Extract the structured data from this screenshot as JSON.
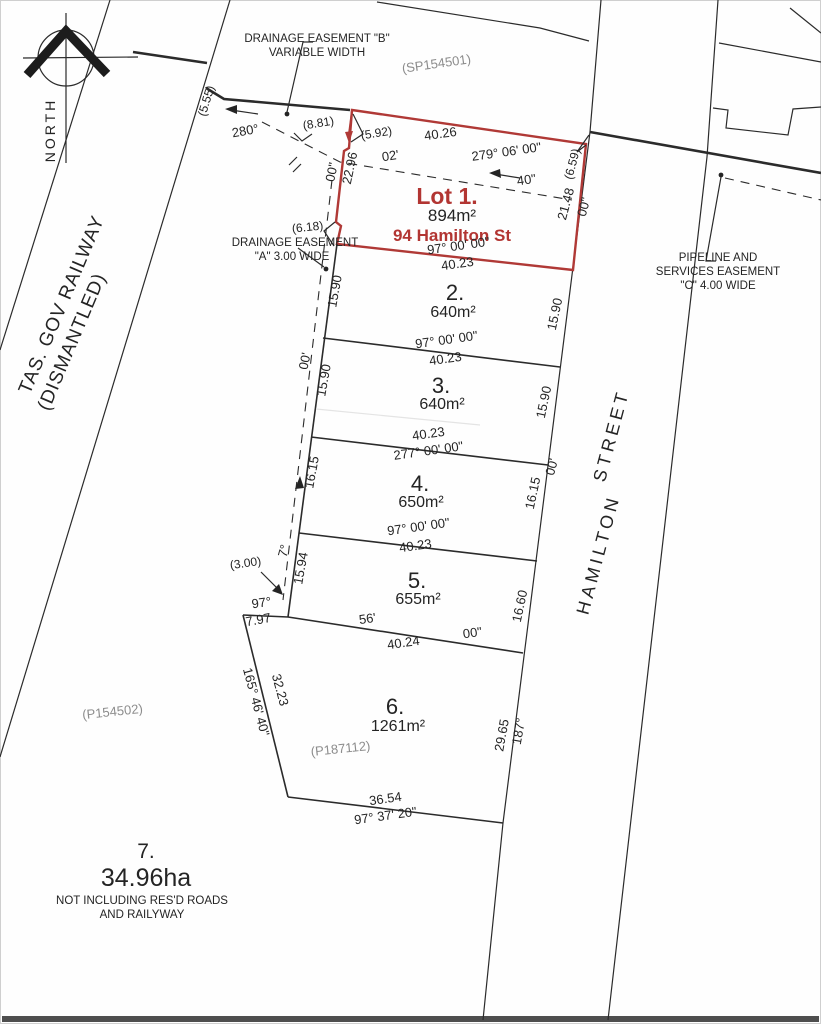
{
  "document": {
    "type": "cadastral survey plan",
    "highlight_color": "#b03936",
    "line_color": "#2b2b2b",
    "plan_reference_color": "#8c8c8c"
  },
  "lots_summary": [
    {
      "id": "1",
      "area": "894m²",
      "address": "94 Hamilton St",
      "highlighted": true
    },
    {
      "id": "2",
      "area": "640m²"
    },
    {
      "id": "3",
      "area": "640m²"
    },
    {
      "id": "4",
      "area": "650m²"
    },
    {
      "id": "5",
      "area": "655m²"
    },
    {
      "id": "6",
      "area": "1261m²"
    },
    {
      "id": "7",
      "area": "34.96ha",
      "note": "NOT INCLUDING RES'D ROADS AND RAILYWAY"
    }
  ],
  "labels": [
    {
      "name": "north-label",
      "text": "NORTH",
      "x": 55,
      "y": 130,
      "rot": -90,
      "cls": "north"
    },
    {
      "name": "railway-label-1",
      "text": "TAS. GOV RAILWAY",
      "x": 67,
      "y": 307,
      "rot": -67,
      "cls": "rail"
    },
    {
      "name": "railway-label-2",
      "text": "(DISMANTLED)",
      "x": 67,
      "y": 307,
      "rot": -67,
      "dx": -30,
      "dy": 24,
      "cls": "rail"
    },
    {
      "name": "street-label-1",
      "text": "HAMILTON",
      "x": 604,
      "y": 556,
      "rot": -75,
      "cls": "street"
    },
    {
      "name": "street-label-2",
      "text": "STREET",
      "x": 617,
      "y": 437,
      "rot": -75,
      "cls": "street"
    },
    {
      "name": "plan-ref-sp154501",
      "text": "(SP154501)",
      "x": 437,
      "y": 68,
      "rot": -8,
      "cls": "plan"
    },
    {
      "name": "easement-b-line1",
      "text": "DRAINAGE EASEMENT \"B\"",
      "x": 317,
      "y": 42,
      "rot": 0,
      "cls": "ease",
      "anchor": "start"
    },
    {
      "name": "easement-b-line2",
      "text": "VARIABLE WIDTH",
      "x": 317,
      "y": 56,
      "rot": 0,
      "cls": "ease",
      "anchor": "start"
    },
    {
      "name": "dim-5-55",
      "text": "(5.55)",
      "x": 210,
      "y": 102,
      "rot": -73,
      "cls": "small"
    },
    {
      "name": "bearing-280",
      "text": "280°",
      "x": 246,
      "y": 135,
      "rot": -10,
      "cls": "dim"
    },
    {
      "name": "dim-8-81",
      "text": "(8.81)",
      "x": 319,
      "y": 127,
      "rot": -9,
      "cls": "small"
    },
    {
      "name": "dim-5-92",
      "text": "(5.92)",
      "x": 377,
      "y": 137,
      "rot": -9,
      "cls": "small"
    },
    {
      "name": "lot1-west-length",
      "text": "22.96",
      "x": 354,
      "y": 169,
      "rot": -78,
      "cls": "dim"
    },
    {
      "name": "bearing-frag-00s-a",
      "text": "00\"",
      "x": 336,
      "y": 173,
      "rot": -78,
      "cls": "dim"
    },
    {
      "name": "bearing-frag-02m",
      "text": "02'",
      "x": 391,
      "y": 160,
      "rot": -9,
      "cls": "dim"
    },
    {
      "name": "lot1-top-length",
      "text": "40.26",
      "x": 441,
      "y": 138,
      "rot": -8,
      "cls": "dim"
    },
    {
      "name": "lot1-top-bearing",
      "text": "279° 06' 00\"",
      "x": 507,
      "y": 156,
      "rot": -8,
      "cls": "dim"
    },
    {
      "name": "bearing-frag-40s",
      "text": "40\"",
      "x": 527,
      "y": 184,
      "rot": -8,
      "cls": "dim"
    },
    {
      "name": "dim-6-59",
      "text": "(6.59)",
      "x": 576,
      "y": 165,
      "rot": -75,
      "cls": "small"
    },
    {
      "name": "lot1-east-length",
      "text": "21.48",
      "x": 570,
      "y": 205,
      "rot": -75,
      "cls": "dim"
    },
    {
      "name": "bearing-frag-00s-b",
      "text": "00\"",
      "x": 588,
      "y": 208,
      "rot": -75,
      "cls": "dim"
    },
    {
      "name": "lot1-name",
      "text": "Lot 1.",
      "x": 447,
      "y": 204,
      "rot": 0,
      "cls": "lot1name"
    },
    {
      "name": "lot1-area",
      "text": "894m²",
      "x": 452,
      "y": 221,
      "rot": 0,
      "cls": "lot1area"
    },
    {
      "name": "lot1-address",
      "text": "94 Hamilton St",
      "x": 452,
      "y": 241,
      "rot": 0,
      "cls": "lot1addr"
    },
    {
      "name": "lot1-bottom-bearing",
      "text": "97° 00' 00\"",
      "x": 459,
      "y": 250,
      "rot": -8,
      "cls": "dim"
    },
    {
      "name": "lot1-bottom-length",
      "text": "40.23",
      "x": 458,
      "y": 268,
      "rot": -8,
      "cls": "dim"
    },
    {
      "name": "easement-a-line1",
      "text": "DRAINAGE EASEMENT",
      "x": 295,
      "y": 246,
      "rot": 0,
      "cls": "ease",
      "anchor": "end"
    },
    {
      "name": "easement-a-line2",
      "text": "\"A\" 3.00 WIDE",
      "x": 292,
      "y": 260,
      "rot": 0,
      "cls": "ease",
      "anchor": "end"
    },
    {
      "name": "dim-6-18",
      "text": "(6.18)",
      "x": 308,
      "y": 231,
      "rot": -6,
      "cls": "small"
    },
    {
      "name": "lot2-west-length",
      "text": "15.90",
      "x": 339,
      "y": 292,
      "rot": -80,
      "cls": "dim"
    },
    {
      "name": "lot2-number",
      "text": "2.",
      "x": 455,
      "y": 300,
      "rot": 0,
      "cls": "lotnum"
    },
    {
      "name": "lot2-area",
      "text": "640m²",
      "x": 453,
      "y": 317,
      "rot": 0,
      "cls": "area"
    },
    {
      "name": "lot2-east-length",
      "text": "15.90",
      "x": 559,
      "y": 315,
      "rot": -78,
      "cls": "dim"
    },
    {
      "name": "lot2-3-bearing",
      "text": "97° 00' 00\"",
      "x": 447,
      "y": 344,
      "rot": -8,
      "cls": "dim"
    },
    {
      "name": "lot2-3-length",
      "text": "40.23",
      "x": 446,
      "y": 363,
      "rot": -8,
      "cls": "dim"
    },
    {
      "name": "bearing-frag-00m-e",
      "text": "00'",
      "x": 309,
      "y": 362,
      "rot": -78,
      "cls": "dim"
    },
    {
      "name": "lot3-west-length",
      "text": "15.90",
      "x": 328,
      "y": 381,
      "rot": -80,
      "cls": "dim"
    },
    {
      "name": "lot3-number",
      "text": "3.",
      "x": 441,
      "y": 393,
      "rot": 0,
      "cls": "lotnum"
    },
    {
      "name": "lot3-area",
      "text": "640m²",
      "x": 442,
      "y": 409,
      "rot": 0,
      "cls": "area"
    },
    {
      "name": "lot3-east-length",
      "text": "15.90",
      "x": 548,
      "y": 403,
      "rot": -78,
      "cls": "dim"
    },
    {
      "name": "lot3-4-length",
      "text": "40.23",
      "x": 429,
      "y": 438,
      "rot": -8,
      "cls": "dim"
    },
    {
      "name": "lot3-4-bearing",
      "text": "277° 00' 00\"",
      "x": 429,
      "y": 455,
      "rot": -8,
      "cls": "dim"
    },
    {
      "name": "lot4-west-length",
      "text": "16.15",
      "x": 316,
      "y": 473,
      "rot": -80,
      "cls": "dim"
    },
    {
      "name": "bearing-frag-00m-c",
      "text": "00'",
      "x": 556,
      "y": 468,
      "rot": -75,
      "cls": "dim"
    },
    {
      "name": "lot4-number",
      "text": "4.",
      "x": 420,
      "y": 491,
      "rot": 0,
      "cls": "lotnum"
    },
    {
      "name": "lot4-area",
      "text": "650m²",
      "x": 421,
      "y": 507,
      "rot": 0,
      "cls": "area"
    },
    {
      "name": "lot4-east-length",
      "text": "16.15",
      "x": 537,
      "y": 494,
      "rot": -78,
      "cls": "dim"
    },
    {
      "name": "lot4-5-bearing",
      "text": "97° 00' 00\"",
      "x": 419,
      "y": 531,
      "rot": -8,
      "cls": "dim"
    },
    {
      "name": "lot4-5-length",
      "text": "40.23",
      "x": 416,
      "y": 550,
      "rot": -8,
      "cls": "dim"
    },
    {
      "name": "bearing-frag-7d",
      "text": "7°",
      "x": 288,
      "y": 552,
      "rot": -75,
      "cls": "dim"
    },
    {
      "name": "lot5-west-length",
      "text": "15.94",
      "x": 305,
      "y": 569,
      "rot": -80,
      "cls": "dim"
    },
    {
      "name": "dim-3-00",
      "text": "(3.00)",
      "x": 246,
      "y": 567,
      "rot": -8,
      "cls": "small"
    },
    {
      "name": "lot5-number",
      "text": "5.",
      "x": 417,
      "y": 588,
      "rot": 0,
      "cls": "lotnum"
    },
    {
      "name": "lot5-area",
      "text": "655m²",
      "x": 418,
      "y": 604,
      "rot": 0,
      "cls": "area"
    },
    {
      "name": "lot5-east-length",
      "text": "16.60",
      "x": 524,
      "y": 607,
      "rot": -78,
      "cls": "dim"
    },
    {
      "name": "bearing-frag-97d",
      "text": "97°",
      "x": 262,
      "y": 607,
      "rot": -8,
      "cls": "dim"
    },
    {
      "name": "dim-7-97",
      "text": "7.97",
      "x": 259,
      "y": 624,
      "rot": -10,
      "cls": "dim"
    },
    {
      "name": "bearing-frag-56m",
      "text": "56'",
      "x": 368,
      "y": 623,
      "rot": -8,
      "cls": "dim"
    },
    {
      "name": "bearing-frag-00s-d",
      "text": "00\"",
      "x": 473,
      "y": 637,
      "rot": -8,
      "cls": "dim"
    },
    {
      "name": "lot5-6-length",
      "text": "40.24",
      "x": 404,
      "y": 647,
      "rot": -8,
      "cls": "dim"
    },
    {
      "name": "lot6-number",
      "text": "6.",
      "x": 395,
      "y": 714,
      "rot": 0,
      "cls": "lotnum"
    },
    {
      "name": "lot6-area",
      "text": "1261m²",
      "x": 398,
      "y": 731,
      "rot": 0,
      "cls": "area"
    },
    {
      "name": "plan-ref-p187112",
      "text": "(P187112)",
      "x": 341,
      "y": 753,
      "rot": -6,
      "cls": "plan"
    },
    {
      "name": "lot6-west-bearing",
      "text": "165° 46' 40\"",
      "x": 252,
      "y": 703,
      "rot": 75,
      "cls": "dim"
    },
    {
      "name": "lot6-west-length",
      "text": "32.23",
      "x": 276,
      "y": 691,
      "rot": 75,
      "cls": "dim"
    },
    {
      "name": "lot6-east-length",
      "text": "29.65",
      "x": 506,
      "y": 736,
      "rot": -80,
      "cls": "dim"
    },
    {
      "name": "bearing-frag-187d",
      "text": "187°",
      "x": 523,
      "y": 732,
      "rot": -80,
      "cls": "dim"
    },
    {
      "name": "lot6-bottom-length",
      "text": "36.54",
      "x": 386,
      "y": 803,
      "rot": -8,
      "cls": "dim"
    },
    {
      "name": "lot6-bottom-bearing",
      "text": "97° 37' 20\"",
      "x": 386,
      "y": 820,
      "rot": -8,
      "cls": "dim"
    },
    {
      "name": "plan-ref-p154502",
      "text": "(P154502)",
      "x": 113,
      "y": 716,
      "rot": -6,
      "cls": "plan"
    },
    {
      "name": "lot7-number",
      "text": "7.",
      "x": 146,
      "y": 858,
      "rot": 0,
      "cls": "big7"
    },
    {
      "name": "lot7-area",
      "text": "34.96ha",
      "x": 146,
      "y": 886,
      "rot": 0,
      "cls": "ha"
    },
    {
      "name": "lot7-note-1",
      "text": "NOT INCLUDING RES'D ROADS",
      "x": 142,
      "y": 904,
      "rot": 0,
      "cls": "note"
    },
    {
      "name": "lot7-note-2",
      "text": "AND RAILYWAY",
      "x": 142,
      "y": 918,
      "rot": 0,
      "cls": "note"
    },
    {
      "name": "easement-c-line1",
      "text": "PIPELINE AND",
      "x": 718,
      "y": 261,
      "rot": 0,
      "cls": "ease",
      "anchor": "start"
    },
    {
      "name": "easement-c-line2",
      "text": "SERVICES EASEMENT",
      "x": 718,
      "y": 275,
      "rot": 0,
      "cls": "ease",
      "anchor": "start"
    },
    {
      "name": "easement-c-line3",
      "text": "\"C\" 4.00 WIDE",
      "x": 718,
      "y": 289,
      "rot": 0,
      "cls": "ease",
      "anchor": "start"
    }
  ]
}
